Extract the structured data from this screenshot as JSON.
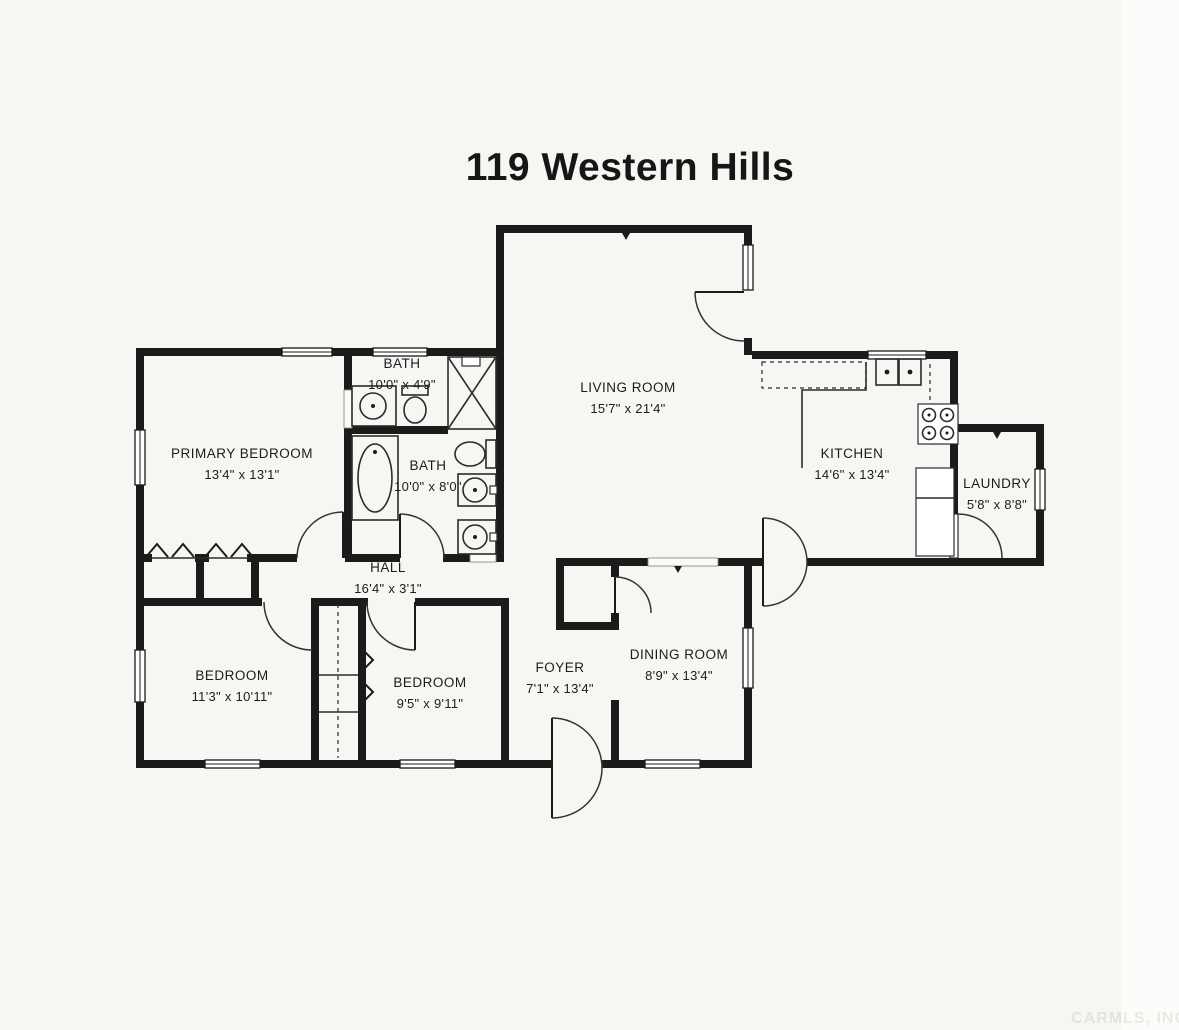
{
  "title": "119 Western Hills",
  "watermark": "CARMLS, INC",
  "colors": {
    "wall": "#1b1b1b",
    "paper": "#f7f6f3",
    "text": "#1c1c1c"
  },
  "rooms": [
    {
      "label": "BATH",
      "dims": "10'0\" x 4'9\"",
      "x": 402,
      "y": 368
    },
    {
      "label": "PRIMARY BEDROOM",
      "dims": "13'4\" x 13'1\"",
      "x": 242,
      "y": 458
    },
    {
      "label": "BATH",
      "dims": "10'0\" x 8'0\"",
      "x": 428,
      "y": 470
    },
    {
      "label": "LIVING ROOM",
      "dims": "15'7\" x 21'4\"",
      "x": 628,
      "y": 392
    },
    {
      "label": "KITCHEN",
      "dims": "14'6\" x 13'4\"",
      "x": 852,
      "y": 458
    },
    {
      "label": "LAUNDRY",
      "dims": "5'8\" x 8'8\"",
      "x": 997,
      "y": 488
    },
    {
      "label": "HALL",
      "dims": "16'4\" x 3'1\"",
      "x": 388,
      "y": 572
    },
    {
      "label": "BEDROOM",
      "dims": "11'3\" x 10'11\"",
      "x": 232,
      "y": 680
    },
    {
      "label": "BEDROOM",
      "dims": "9'5\" x 9'11\"",
      "x": 430,
      "y": 687
    },
    {
      "label": "FOYER",
      "dims": "7'1\" x 13'4\"",
      "x": 560,
      "y": 672
    },
    {
      "label": "DINING ROOM",
      "dims": "8'9\" x 13'4\"",
      "x": 679,
      "y": 659
    }
  ],
  "fixtures": [
    "shower",
    "bathtub",
    "toilet",
    "vanity-sink",
    "double-vanity-sinks",
    "kitchen-double-sink",
    "range",
    "refrigerator",
    "closet-bifold",
    "swing-door"
  ]
}
